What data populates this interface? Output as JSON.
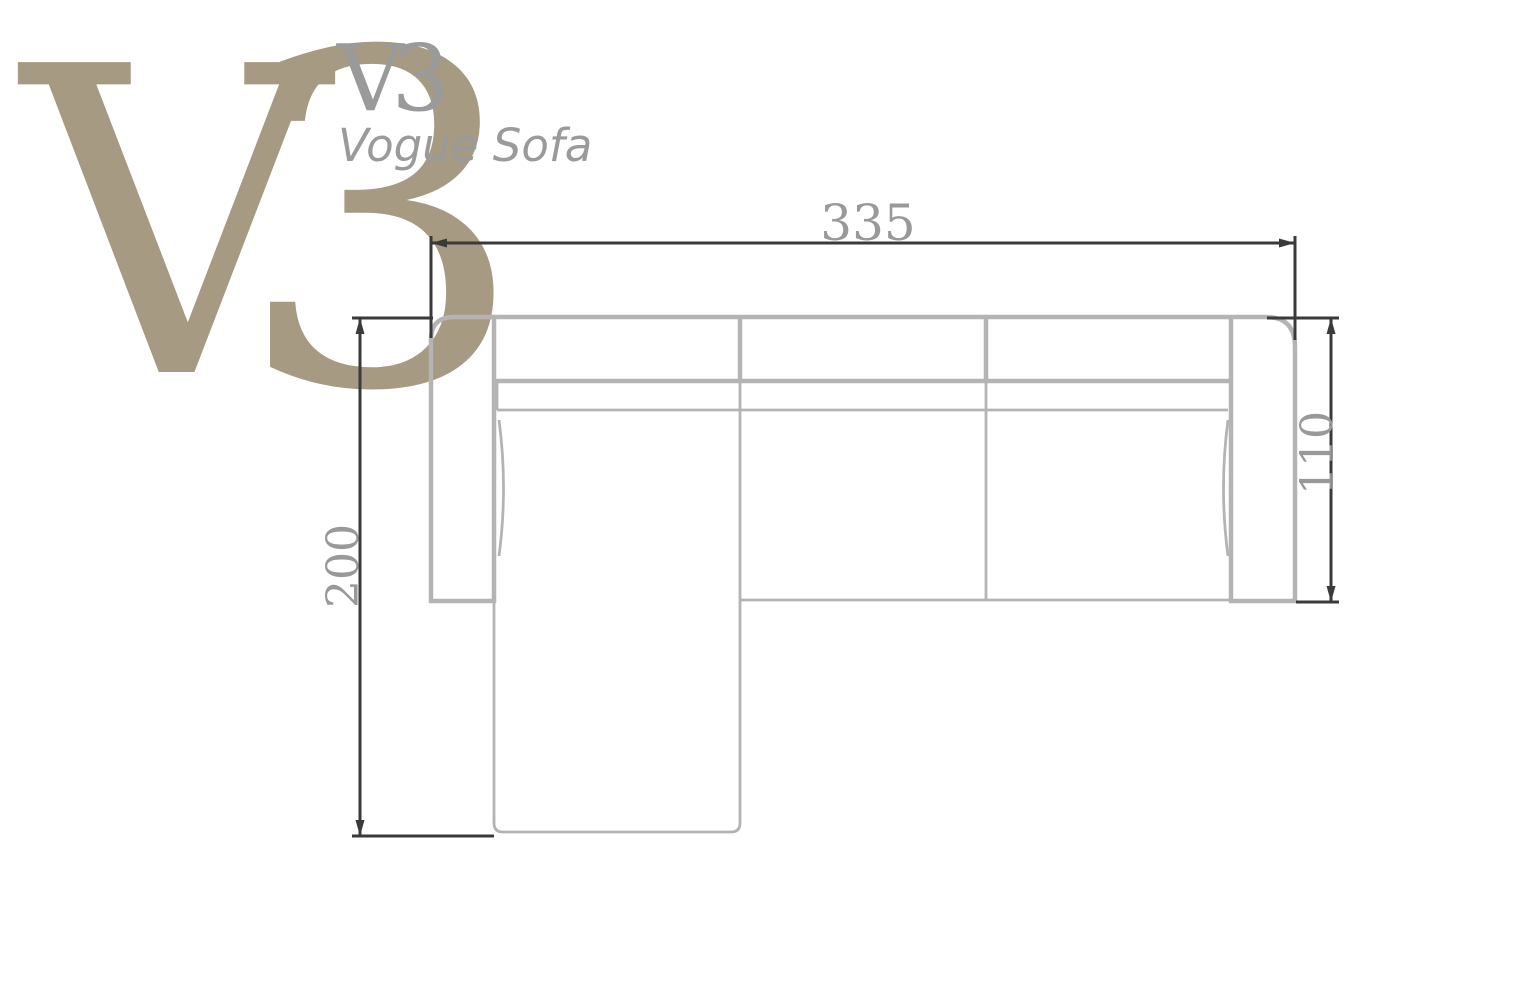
{
  "logo": {
    "big_v": "V",
    "big_3": "3",
    "small_mark": "V3",
    "product_name": "Vogue Sofa"
  },
  "diagram": {
    "view": "sofa top view dimension drawing",
    "dimensions": {
      "overall_width": "335",
      "chaise_depth": "200",
      "seat_depth": "110"
    }
  },
  "colors": {
    "logo_tan": "#a69a82",
    "logo_gray": "#9a9a9a",
    "drawing_gray": "#b4b4b4",
    "dimension_dark": "#3a3a3a",
    "dimension_text": "#999999"
  }
}
